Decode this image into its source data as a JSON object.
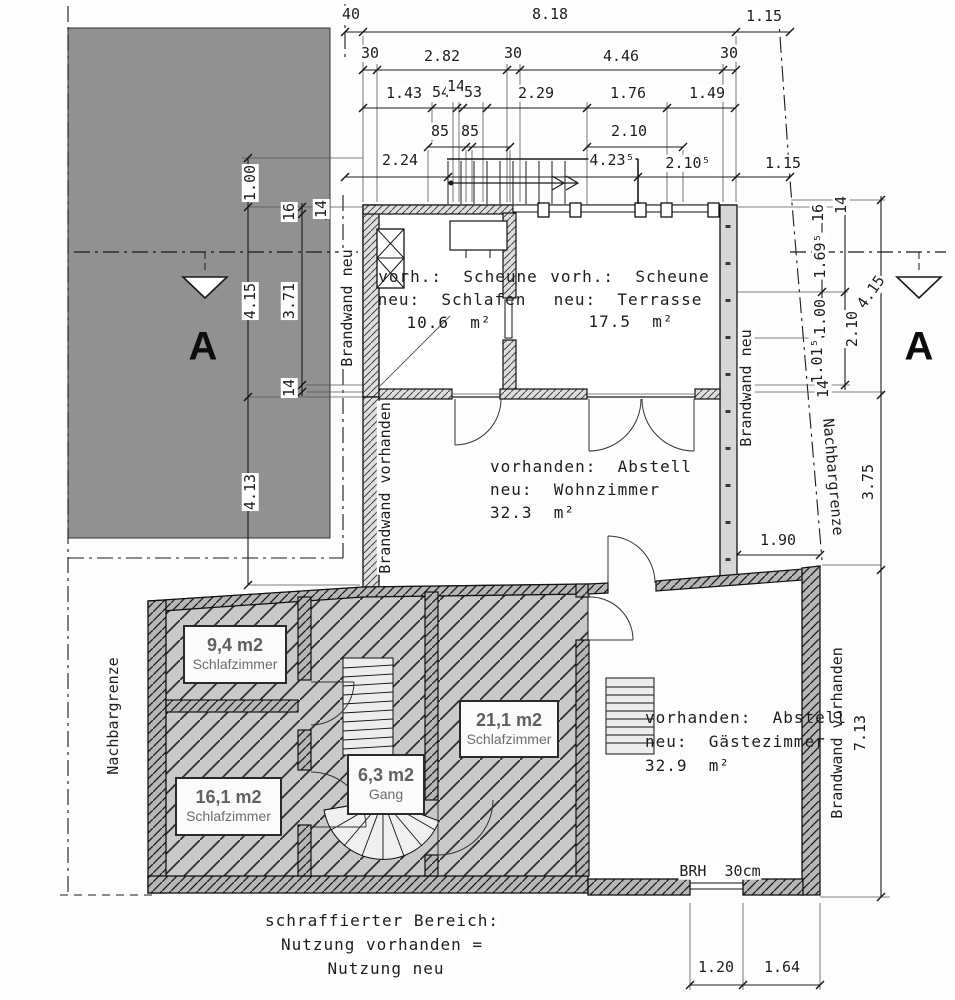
{
  "dims": {
    "row1": [
      "40",
      "8.18",
      "1.15"
    ],
    "row2": [
      "30",
      "2.82",
      "30",
      "4.46",
      "30"
    ],
    "row3": [
      "1.43",
      "54",
      "14",
      "53",
      "2.29",
      "1.76",
      "1.49"
    ],
    "row4": [
      "85",
      "85",
      "2.10"
    ],
    "row5": [
      "2.24",
      "4.23⁵",
      "2.10⁵",
      "1.15"
    ],
    "left": [
      "1.00",
      "16",
      "14",
      "4.15",
      "3.71",
      "14",
      "4.13"
    ],
    "right": [
      "16",
      "14",
      "1.69⁵",
      "1.00",
      "1.01⁵",
      "14",
      "2.10",
      "4.15",
      "3.75",
      "1.90",
      "7.13"
    ],
    "bottom": [
      "1.20",
      "1.64"
    ]
  },
  "rooms": [
    {
      "line1": "vorh.:  Scheune",
      "line2": "neu:  Schlafen",
      "area": "10.6  m²"
    },
    {
      "line1": "vorh.:  Scheune",
      "line2": "neu:  Terrasse",
      "area": "17.5  m²"
    },
    {
      "line1": "vorhanden:  Abstell",
      "line2": "neu:  Wohnzimmer",
      "area": "32.3  m²"
    },
    {
      "line1": "vorhanden:  Abstell",
      "line2": "neu:  Gästezimmer",
      "area": "32.9  m²"
    }
  ],
  "tags": [
    {
      "area": "9,4 m2",
      "name": "Schlafzimmer"
    },
    {
      "area": "21,1 m2",
      "name": "Schlafzimmer"
    },
    {
      "area": "16,1 m2",
      "name": "Schlafzimmer"
    },
    {
      "area": "6,3 m2",
      "name": "Gang"
    }
  ],
  "annotations": {
    "brandwand_neu_left": "Brandwand neu",
    "brandwand_vorhanden_left": "Brandwand vorhanden",
    "nachbargrenze_left": "Nachbargrenze",
    "brandwand_neu_right": "Brandwand neu",
    "nachbargrenze_right": "Nachbargrenze",
    "brandwand_vorhanden_right": "Brandwand vorhanden",
    "section_marker": "A",
    "brh": "BRH  30cm"
  },
  "legend": {
    "line1": "schraffierter Bereich:",
    "line2": "Nutzung vorhanden =",
    "line3": "Nutzung neu"
  },
  "colors": {
    "neighbor_building": "#919191",
    "hatched_area_fill": "#c9c9c9",
    "wall_fill": "#dedede",
    "dark_wall_fill": "#b6b6b6",
    "line": "#1a1a1a"
  }
}
